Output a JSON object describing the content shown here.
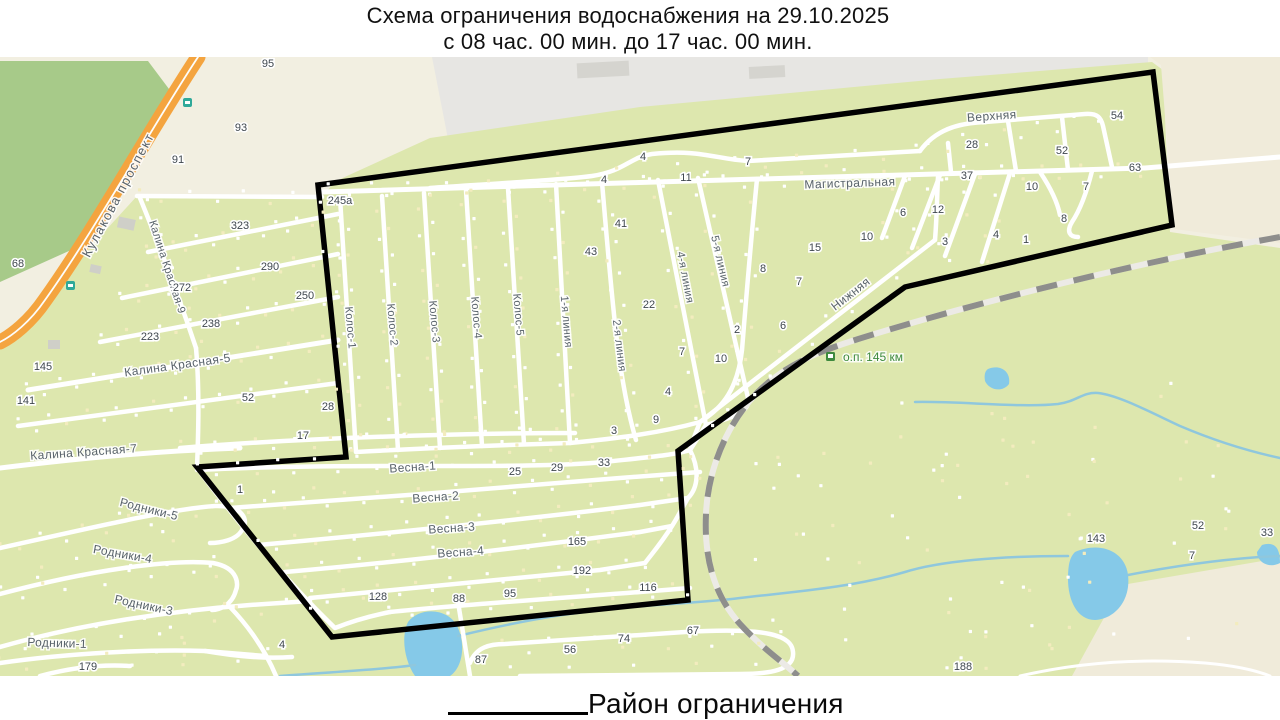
{
  "title": {
    "line1": "Схема ограничения водоснабжения на 29.10.2025",
    "line2": "с 08 час. 00 мин. до 17 час. 00 мин."
  },
  "legend": {
    "label": "Район ограничения"
  },
  "map": {
    "colors": {
      "beige": "#f2efe1",
      "beige_wedge": "#f0ebda",
      "industrial": "#e7e6e3",
      "building": "#d5d4cf",
      "forest": "#a7ca89",
      "garden": "#dde7ae",
      "water": "#85c9e8",
      "stream": "#8fc7dd",
      "road": "#ffffff",
      "highway_orange": "#f4a43f",
      "railway_dash": "#8e8e8c",
      "restriction_outline": "#000000",
      "poi_green": "#3e8a3e"
    },
    "street_labels": [
      {
        "text": "Кулакова проспект",
        "x": 122,
        "y": 197,
        "r": -62,
        "s": 13,
        "ls": 1.5
      },
      {
        "text": "Калина Красная-9",
        "x": 164,
        "y": 268,
        "r": 72,
        "s": 11,
        "ls": 0.3
      },
      {
        "text": "Калина Красная-5",
        "x": 178,
        "y": 369,
        "r": -8,
        "s": 12,
        "ls": 0.4
      },
      {
        "text": "Калина Красная-7",
        "x": 84,
        "y": 456,
        "r": -4,
        "s": 12,
        "ls": 0.4
      },
      {
        "text": "Родники-5",
        "x": 148,
        "y": 513,
        "r": 14,
        "s": 12,
        "ls": 0.3
      },
      {
        "text": "Родники-4",
        "x": 122,
        "y": 558,
        "r": 10,
        "s": 12,
        "ls": 0.3
      },
      {
        "text": "Родники-3",
        "x": 143,
        "y": 609,
        "r": 12,
        "s": 12,
        "ls": 0.3
      },
      {
        "text": "Родники-1",
        "x": 57,
        "y": 647,
        "r": 2,
        "s": 12,
        "ls": 0.3
      },
      {
        "text": "Колос-1",
        "x": 347,
        "y": 328,
        "r": 85,
        "s": 11,
        "ls": 0.3
      },
      {
        "text": "Колос-2",
        "x": 389,
        "y": 325,
        "r": 85,
        "s": 11,
        "ls": 0.3
      },
      {
        "text": "Колос-3",
        "x": 431,
        "y": 322,
        "r": 85,
        "s": 11,
        "ls": 0.3
      },
      {
        "text": "Колос-4",
        "x": 473,
        "y": 318,
        "r": 85,
        "s": 11,
        "ls": 0.3
      },
      {
        "text": "Колос-5",
        "x": 515,
        "y": 315,
        "r": 85,
        "s": 11,
        "ls": 0.3
      },
      {
        "text": "1-я линия",
        "x": 563,
        "y": 322,
        "r": 85,
        "s": 11,
        "ls": 0.3
      },
      {
        "text": "2-я линия",
        "x": 616,
        "y": 346,
        "r": 83,
        "s": 11,
        "ls": 0.3
      },
      {
        "text": "4-я линия",
        "x": 682,
        "y": 278,
        "r": 79,
        "s": 11,
        "ls": 0.3
      },
      {
        "text": "5-я линия",
        "x": 717,
        "y": 262,
        "r": 77,
        "s": 11,
        "ls": 0.3
      },
      {
        "text": "Магистральная",
        "x": 850,
        "y": 187,
        "r": -2,
        "s": 12,
        "ls": 0.4
      },
      {
        "text": "Верхняя",
        "x": 992,
        "y": 120,
        "r": -4,
        "s": 12,
        "ls": 0.4
      },
      {
        "text": "Нижняя",
        "x": 853,
        "y": 297,
        "r": -38,
        "s": 12,
        "ls": 0.4
      },
      {
        "text": "Весна-1",
        "x": 413,
        "y": 471,
        "r": -4,
        "s": 12,
        "ls": 0.3
      },
      {
        "text": "Весна-2",
        "x": 436,
        "y": 501,
        "r": -4,
        "s": 12,
        "ls": 0.3
      },
      {
        "text": "Весна-3",
        "x": 452,
        "y": 532,
        "r": -4,
        "s": 12,
        "ls": 0.3
      },
      {
        "text": "Весна-4",
        "x": 461,
        "y": 556,
        "r": -4,
        "s": 12,
        "ls": 0.3
      }
    ],
    "poi_labels": [
      {
        "text": "о.п. 145 км",
        "x": 843,
        "y": 361
      }
    ],
    "house_numbers": [
      {
        "t": "95",
        "x": 268,
        "y": 67
      },
      {
        "t": "93",
        "x": 241,
        "y": 131
      },
      {
        "t": "91",
        "x": 178,
        "y": 163
      },
      {
        "t": "68",
        "x": 18,
        "y": 267
      },
      {
        "t": "323",
        "x": 240,
        "y": 229
      },
      {
        "t": "290",
        "x": 270,
        "y": 270
      },
      {
        "t": "272",
        "x": 182,
        "y": 291
      },
      {
        "t": "250",
        "x": 305,
        "y": 299
      },
      {
        "t": "238",
        "x": 211,
        "y": 327
      },
      {
        "t": "223",
        "x": 150,
        "y": 340
      },
      {
        "t": "145",
        "x": 43,
        "y": 370
      },
      {
        "t": "141",
        "x": 26,
        "y": 404
      },
      {
        "t": "52",
        "x": 248,
        "y": 401
      },
      {
        "t": "28",
        "x": 328,
        "y": 410
      },
      {
        "t": "17",
        "x": 303,
        "y": 439
      },
      {
        "t": "245а",
        "x": 340,
        "y": 204
      },
      {
        "t": "4",
        "x": 643,
        "y": 160
      },
      {
        "t": "7",
        "x": 748,
        "y": 165
      },
      {
        "t": "4",
        "x": 604,
        "y": 183
      },
      {
        "t": "11",
        "x": 686,
        "y": 181
      },
      {
        "t": "41",
        "x": 621,
        "y": 227
      },
      {
        "t": "43",
        "x": 591,
        "y": 255
      },
      {
        "t": "22",
        "x": 649,
        "y": 308
      },
      {
        "t": "1",
        "x": 240,
        "y": 493
      },
      {
        "t": "25",
        "x": 515,
        "y": 475
      },
      {
        "t": "29",
        "x": 557,
        "y": 471
      },
      {
        "t": "33",
        "x": 604,
        "y": 466
      },
      {
        "t": "3",
        "x": 614,
        "y": 434
      },
      {
        "t": "9",
        "x": 656,
        "y": 423
      },
      {
        "t": "4",
        "x": 668,
        "y": 395
      },
      {
        "t": "10",
        "x": 721,
        "y": 362
      },
      {
        "t": "7",
        "x": 682,
        "y": 355
      },
      {
        "t": "2",
        "x": 737,
        "y": 333
      },
      {
        "t": "6",
        "x": 783,
        "y": 329
      },
      {
        "t": "8",
        "x": 763,
        "y": 272
      },
      {
        "t": "7",
        "x": 799,
        "y": 285
      },
      {
        "t": "15",
        "x": 815,
        "y": 251
      },
      {
        "t": "10",
        "x": 867,
        "y": 240
      },
      {
        "t": "6",
        "x": 903,
        "y": 216
      },
      {
        "t": "12",
        "x": 938,
        "y": 213
      },
      {
        "t": "3",
        "x": 945,
        "y": 245
      },
      {
        "t": "4",
        "x": 996,
        "y": 238
      },
      {
        "t": "1",
        "x": 1026,
        "y": 243
      },
      {
        "t": "8",
        "x": 1064,
        "y": 222
      },
      {
        "t": "54",
        "x": 1117,
        "y": 119
      },
      {
        "t": "28",
        "x": 972,
        "y": 148
      },
      {
        "t": "52",
        "x": 1062,
        "y": 154
      },
      {
        "t": "63",
        "x": 1135,
        "y": 171
      },
      {
        "t": "37",
        "x": 967,
        "y": 179
      },
      {
        "t": "10",
        "x": 1032,
        "y": 190
      },
      {
        "t": "7",
        "x": 1086,
        "y": 190
      },
      {
        "t": "128",
        "x": 378,
        "y": 600
      },
      {
        "t": "88",
        "x": 459,
        "y": 602
      },
      {
        "t": "95",
        "x": 510,
        "y": 597
      },
      {
        "t": "116",
        "x": 648,
        "y": 591
      },
      {
        "t": "165",
        "x": 577,
        "y": 545
      },
      {
        "t": "192",
        "x": 582,
        "y": 574
      },
      {
        "t": "67",
        "x": 693,
        "y": 634
      },
      {
        "t": "74",
        "x": 624,
        "y": 642
      },
      {
        "t": "56",
        "x": 570,
        "y": 653
      },
      {
        "t": "87",
        "x": 481,
        "y": 663
      },
      {
        "t": "4",
        "x": 282,
        "y": 648
      },
      {
        "t": "179",
        "x": 88,
        "y": 670
      },
      {
        "t": "188",
        "x": 963,
        "y": 670
      },
      {
        "t": "143",
        "x": 1096,
        "y": 542
      },
      {
        "t": "52",
        "x": 1198,
        "y": 529
      },
      {
        "t": "7",
        "x": 1192,
        "y": 559
      },
      {
        "t": "33",
        "x": 1267,
        "y": 536
      }
    ]
  }
}
